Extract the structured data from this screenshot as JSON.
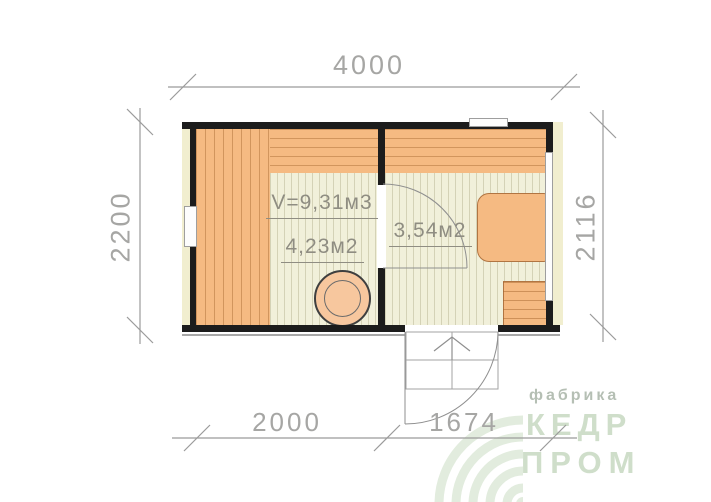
{
  "drawing": {
    "type": "floor-plan",
    "dimensions": {
      "top": "4000",
      "left": "2200",
      "right": "2116",
      "bottom_left": "2000",
      "bottom_right": "1674"
    },
    "labels": {
      "sauna_volume": "V=9,31м3",
      "sauna_area": "4,23м2",
      "hall_area": "3,54м2"
    }
  },
  "logo": {
    "factory": "фабрика",
    "brand_line1": "КЕДР",
    "brand_line2": "ПРОМ"
  },
  "colors": {
    "wall": "#1c1c1c",
    "wood": "#f5ba82",
    "wood_line": "#b4763e",
    "floor": "#f1f0da",
    "trim": "#f1eecf",
    "drawing_line": "#9b9b9b",
    "dimension_text": "#a6a6a4",
    "label_text": "#8f8d82",
    "logo_text": "#cfdeca",
    "logo_subtext": "#b5bfb4",
    "logo_watermark": "#e2ecde"
  }
}
